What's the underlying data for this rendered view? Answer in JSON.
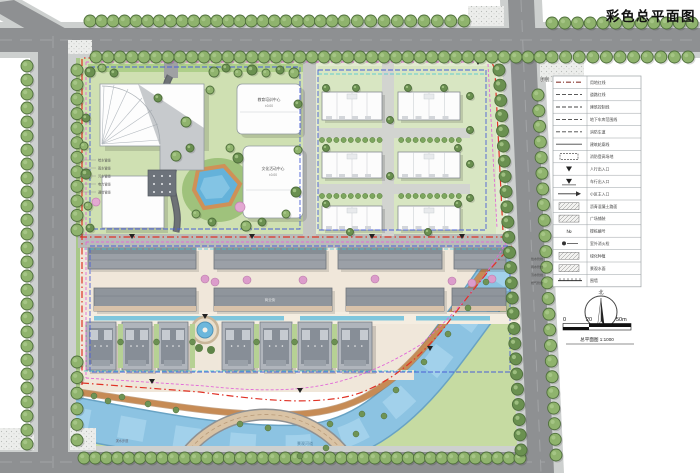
{
  "title": "彩色总平面图",
  "legend": {
    "title": "图例",
    "rows": [
      {
        "symbol": "dashdot",
        "label": "用地红线"
      },
      {
        "symbol": "dash",
        "label": "道路红线"
      },
      {
        "symbol": "dash",
        "label": "建筑控制线"
      },
      {
        "symbol": "dash",
        "label": "地下车库范围线"
      },
      {
        "symbol": "dash",
        "label": "消防车道"
      },
      {
        "symbol": "solid",
        "label": "建筑轮廓线"
      },
      {
        "symbol": "rect",
        "label": "消防登高场地"
      },
      {
        "symbol": "tri",
        "label": "人行出入口"
      },
      {
        "symbol": "tri-dark",
        "label": "车行出入口"
      },
      {
        "symbol": "arrow",
        "label": "小区主入口"
      },
      {
        "symbol": "hatch",
        "label": "沥青混凝土路面"
      },
      {
        "symbol": "hatch",
        "label": "广场铺装"
      },
      {
        "symbol": "num",
        "label": "楼栋编号"
      },
      {
        "symbol": "hydrant",
        "label": "室外消火栓"
      },
      {
        "symbol": "hatch",
        "label": "绿化种植"
      },
      {
        "symbol": "hatch",
        "label": "景观水面"
      },
      {
        "symbol": "wall",
        "label": "围墙"
      }
    ]
  },
  "north": {
    "label": "北"
  },
  "scale_bar": {
    "ticks": [
      "0",
      "20",
      "50m"
    ],
    "caption": "总平面图 1:1000"
  },
  "map": {
    "labels": {
      "building_c": "教育培训中心",
      "building_c_sub": "±0.00",
      "building_d": "文化活动中心",
      "building_d_sub": "±0.00",
      "commercial": "商业街",
      "river": "景观河道",
      "waterfront": "滨水步道"
    },
    "annotations": {
      "left": [
        "给水管线",
        "雨水管线",
        "污水管线",
        "电力管线",
        "通信管线"
      ],
      "right": [
        "给水管线",
        "雨水管线",
        "污水管线",
        "燃气管线"
      ]
    }
  },
  "colors": {
    "road": "#8e9092",
    "sidewalk": "#cdd0cf",
    "tree": "#8fb36d",
    "tree_dark": "#6a9050",
    "grass": "#cfe0b2",
    "lawn": "#c6dba2",
    "water": "#8cc3e2",
    "plaza": "#f0e7da",
    "roof": "#9ba0a7",
    "boundary_red": "#e03226",
    "boundary_magenta": "#e268d8",
    "boundary_blue": "#4a5fd6",
    "boundary_cyan": "#3fc6d2",
    "riverside_path": "#c68b55"
  }
}
